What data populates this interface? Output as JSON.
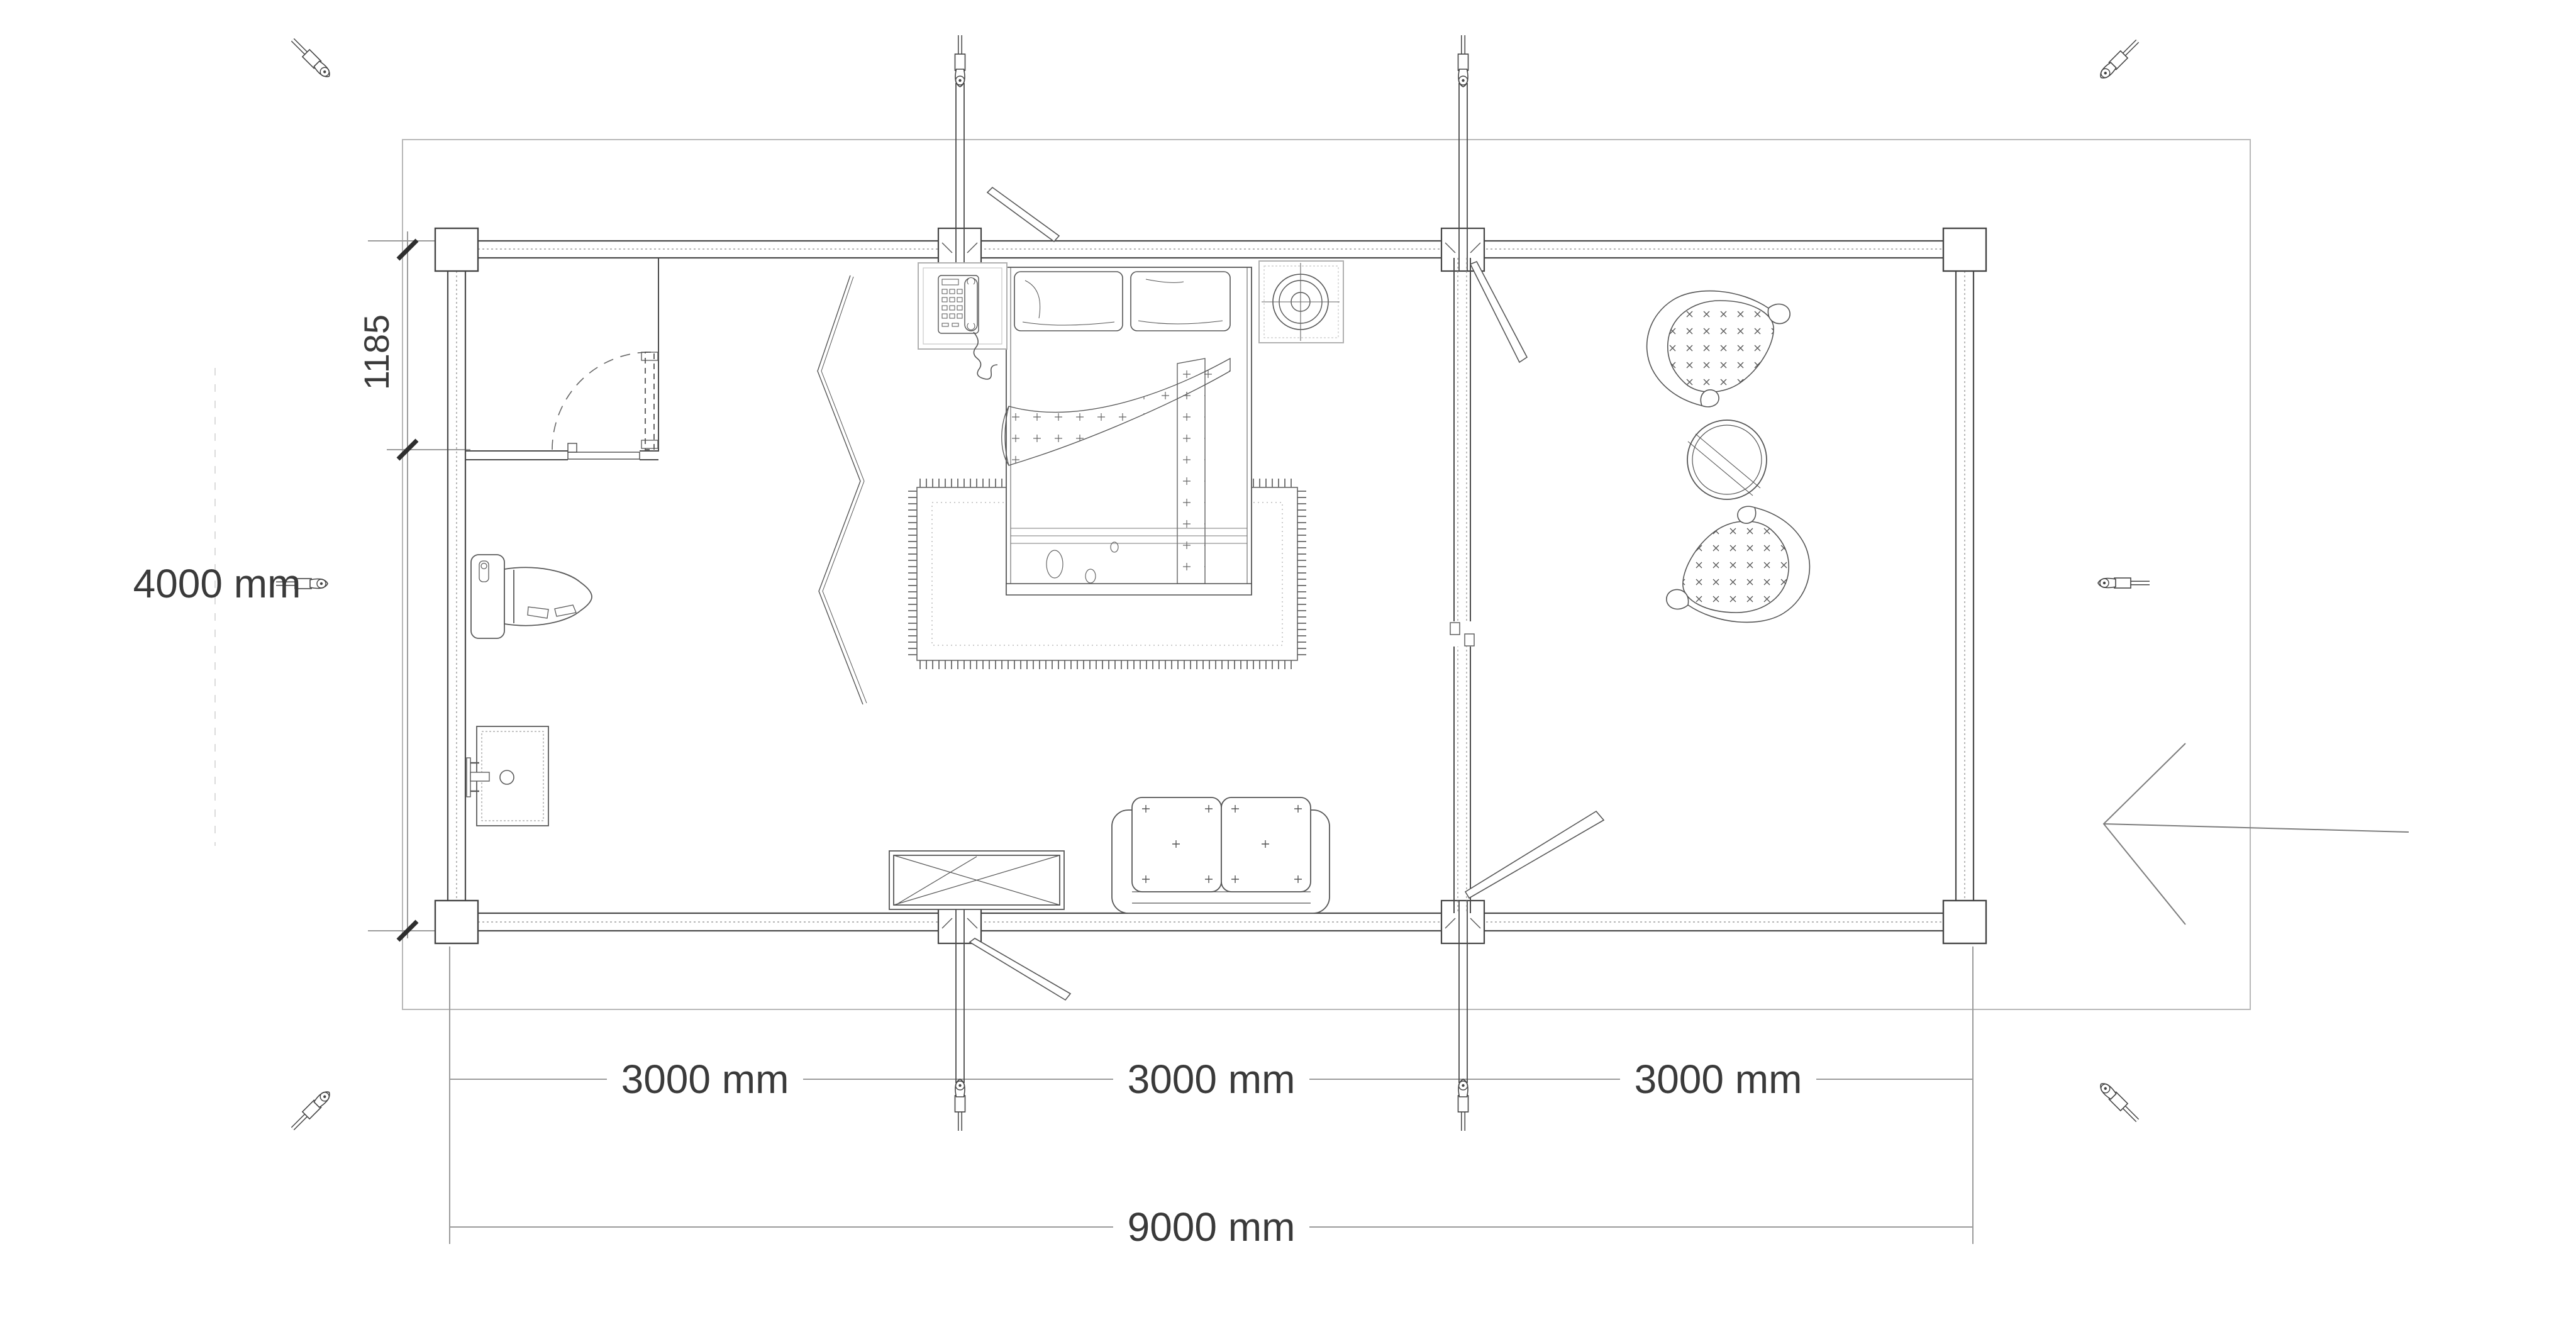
{
  "drawing": {
    "kind": "cabin-floor-plan",
    "units": "mm"
  },
  "dimensions": {
    "overall_width": "9000 mm",
    "overall_height": "4000 mm",
    "bay_widths": [
      "3000 mm",
      "3000 mm",
      "3000 mm"
    ],
    "entry_wall_offset": "1185"
  },
  "colors": {
    "line_main": "#4a4a4a",
    "line_furniture": "#5a5a5a",
    "line_light": "#b5b5b5",
    "line_dimension": "#9b9b9b",
    "tick": "#2e2e2e",
    "text": "#3a3a3a",
    "background": "#ffffff"
  },
  "icons": {
    "anchor_fitting": "turnbuckle-anchor",
    "arrow": "entry-direction-arrow"
  }
}
